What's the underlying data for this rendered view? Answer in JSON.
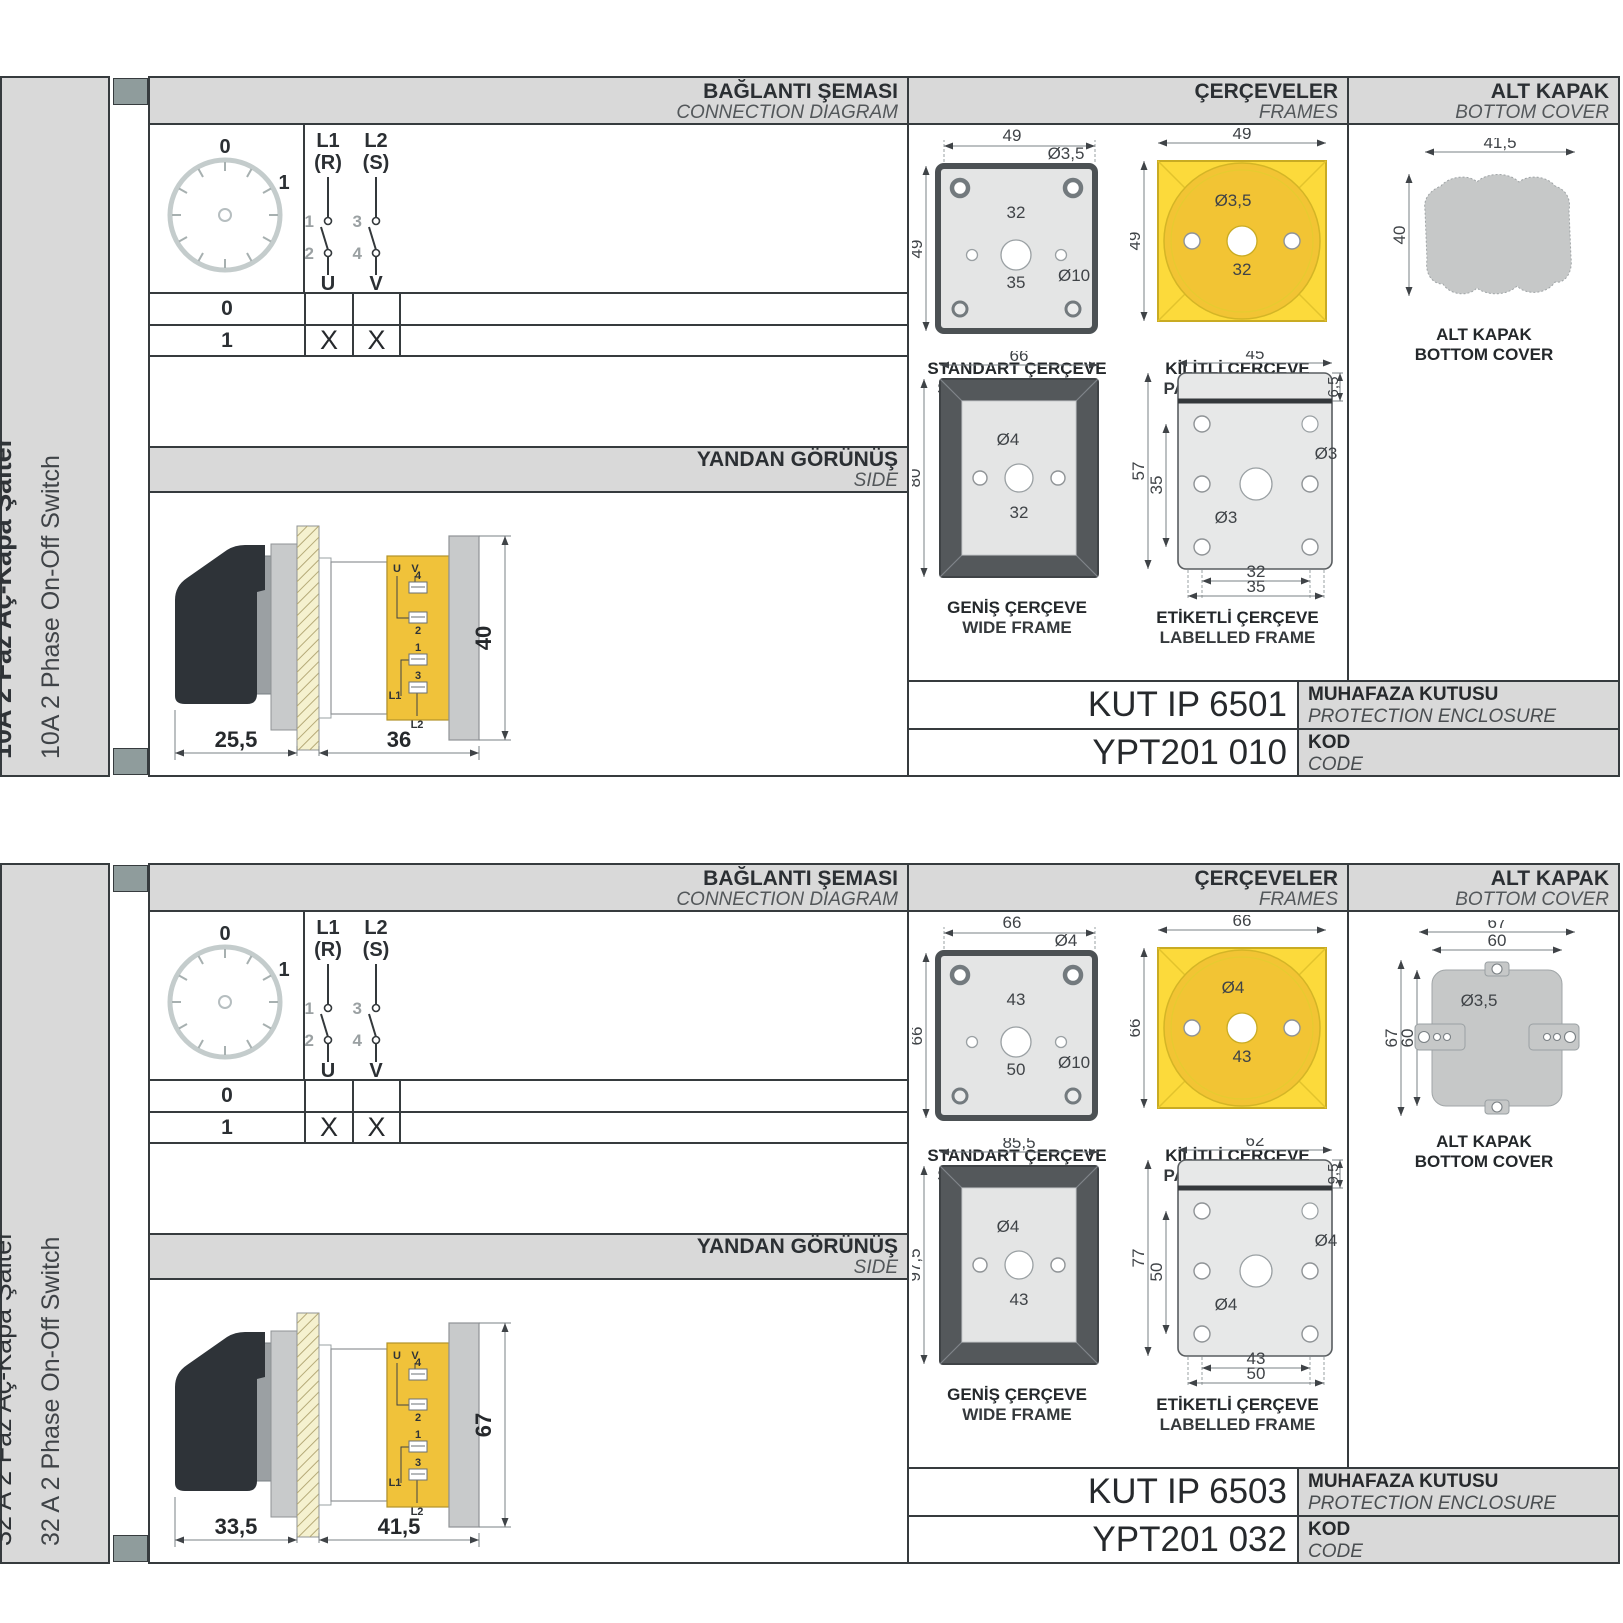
{
  "page": {
    "accent_yellow": "#fcda3b",
    "panel_gray": "#d9d9d9"
  },
  "sections": [
    {
      "product_tr": "10A 2 Faz Aç-Kapa Şalter",
      "product_en": "10A 2 Phase On-Off Switch",
      "headers": {
        "diagram_tr": "BAĞLANTI ŞEMASI",
        "diagram_en": "CONNECTION DIAGRAM",
        "frames_tr": "ÇERÇEVELER",
        "frames_en": "FRAMES",
        "cover_tr": "ALT KAPAK",
        "cover_en": "BOTTOM COVER",
        "side_tr": "YANDAN GÖRÜNÜŞ",
        "side_en": "SIDE"
      },
      "diagram": {
        "dial_zero": "0",
        "dial_one": "1",
        "pole1": {
          "line1": "L1",
          "line2": "(R)",
          "c1": "1",
          "c2": "2",
          "out": "U"
        },
        "pole2": {
          "line1": "L2",
          "line2": "(S)",
          "c1": "3",
          "c2": "4",
          "out": "V"
        },
        "rows": [
          {
            "pos": "0",
            "u": "",
            "v": ""
          },
          {
            "pos": "1",
            "u": "X",
            "v": "X"
          }
        ]
      },
      "side_view": {
        "dim_front": "25,5",
        "dim_body": "36",
        "dim_height": "40",
        "t_u": "U",
        "t_v": "V",
        "t_4": "4",
        "t_2": "2",
        "t_1": "1",
        "t_3": "3",
        "t_l1": "L1",
        "t_l2": "L2"
      },
      "frames": {
        "standard": {
          "cap_tr": "STANDART ÇERÇEVE",
          "cap_en": "STANDARD FRAME",
          "w": "49",
          "h": "49",
          "hole": "Ø3,5",
          "span": "32",
          "center": "Ø10",
          "span2": "35"
        },
        "padlock": {
          "cap_tr": "KİLİTLİ ÇERÇEVE",
          "cap_en": "PADLOCK FRAME",
          "w": "49",
          "h": "49",
          "hole": "Ø3,5",
          "span": "32"
        },
        "wide": {
          "cap_tr": "GENİŞ ÇERÇEVE",
          "cap_en": "WIDE FRAME",
          "w": "66",
          "h": "80",
          "hole": "Ø4",
          "span": "32"
        },
        "labelled": {
          "cap_tr": "ETİKETLİ ÇERÇEVE",
          "cap_en": "LABELLED FRAME",
          "w": "45",
          "h": "57",
          "h2": "35",
          "top": "6,5",
          "hole1": "Ø3",
          "hole2": "Ø3",
          "span1": "32",
          "span2": "35"
        }
      },
      "cover": {
        "cap_tr": "ALT KAPAK",
        "cap_en": "BOTTOM COVER",
        "w": "41,5",
        "h": "40"
      },
      "enclosure": {
        "value": "KUT IP 6501",
        "tr": "MUHAFAZA KUTUSU",
        "en": "PROTECTION ENCLOSURE"
      },
      "code": {
        "value": "YPT201 010",
        "tr": "KOD",
        "en": "CODE"
      }
    },
    {
      "product_tr": "32 A 2 Faz Aç-Kapa Şalter",
      "product_en": "32 A 2 Phase On-Off Switch",
      "headers": {
        "diagram_tr": "BAĞLANTI ŞEMASI",
        "diagram_en": "CONNECTION DIAGRAM",
        "frames_tr": "ÇERÇEVELER",
        "frames_en": "FRAMES",
        "cover_tr": "ALT KAPAK",
        "cover_en": "BOTTOM COVER",
        "side_tr": "YANDAN GÖRÜNÜŞ",
        "side_en": "SIDE"
      },
      "diagram": {
        "dial_zero": "0",
        "dial_one": "1",
        "pole1": {
          "line1": "L1",
          "line2": "(R)",
          "c1": "1",
          "c2": "2",
          "out": "U"
        },
        "pole2": {
          "line1": "L2",
          "line2": "(S)",
          "c1": "3",
          "c2": "4",
          "out": "V"
        },
        "rows": [
          {
            "pos": "0",
            "u": "",
            "v": ""
          },
          {
            "pos": "1",
            "u": "X",
            "v": "X"
          }
        ]
      },
      "side_view": {
        "dim_front": "33,5",
        "dim_body": "41,5",
        "dim_height": "67",
        "t_u": "U",
        "t_v": "V",
        "t_4": "4",
        "t_2": "2",
        "t_1": "1",
        "t_3": "3",
        "t_l1": "L1",
        "t_l2": "L2"
      },
      "frames": {
        "standard": {
          "cap_tr": "STANDART ÇERÇEVE",
          "cap_en": "STANDARD FRAME",
          "w": "66",
          "h": "66",
          "hole": "Ø4",
          "span": "43",
          "center": "Ø10",
          "span2": "50"
        },
        "padlock": {
          "cap_tr": "KİLİTLİ ÇERÇEVE",
          "cap_en": "PADLOCK FRAME",
          "w": "66",
          "h": "66",
          "hole": "Ø4",
          "span": "43"
        },
        "wide": {
          "cap_tr": "GENİŞ ÇERÇEVE",
          "cap_en": "WIDE FRAME",
          "w": "85,5",
          "h": "97,5",
          "hole": "Ø4",
          "span": "43"
        },
        "labelled": {
          "cap_tr": "ETİKETLİ ÇERÇEVE",
          "cap_en": "LABELLED FRAME",
          "w": "62",
          "h": "77",
          "h2": "50",
          "top": "9,5",
          "hole1": "Ø4",
          "hole2": "Ø4",
          "span1": "43",
          "span2": "50"
        }
      },
      "cover": {
        "cap_tr": "ALT KAPAK",
        "cap_en": "BOTTOM COVER",
        "w": "67",
        "w2": "60",
        "h": "67",
        "h2": "60",
        "hole": "Ø3,5"
      },
      "enclosure": {
        "value": "KUT IP 6503",
        "tr": "MUHAFAZA KUTUSU",
        "en": "PROTECTION ENCLOSURE"
      },
      "code": {
        "value": "YPT201 032",
        "tr": "KOD",
        "en": "CODE"
      }
    }
  ]
}
